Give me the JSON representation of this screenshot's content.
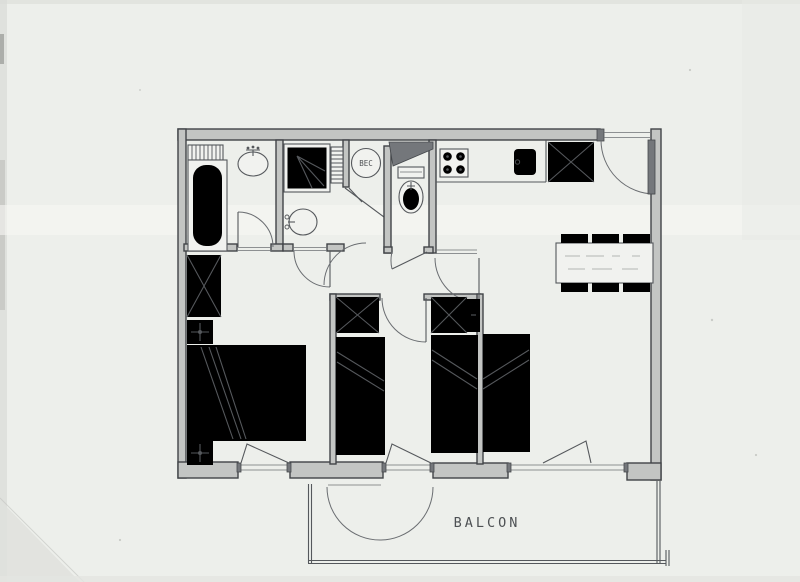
{
  "labels": {
    "water_heater": "BEC",
    "balcony": "BALCON"
  },
  "palette": {
    "paper": "#edefeb",
    "ink": "#55585c",
    "ink_soft": "#6a6d71",
    "wall_fill": "#c3c5c3",
    "wall_edge": "#414448",
    "wall_dark": "#74777b"
  },
  "fixtures": [
    "bathtub-icon",
    "towel-radiator-icon",
    "washbasin-icon",
    "shower-icon",
    "water-heater-icon",
    "toilet-icon",
    "stove-icon",
    "kitchen-sink-icon",
    "wardrobe-icon",
    "dining-table-icon",
    "chair-icon",
    "double-bed-icon",
    "single-bed-icon",
    "nightstand-lamp-icon",
    "door-swing-icon",
    "window-icon"
  ]
}
